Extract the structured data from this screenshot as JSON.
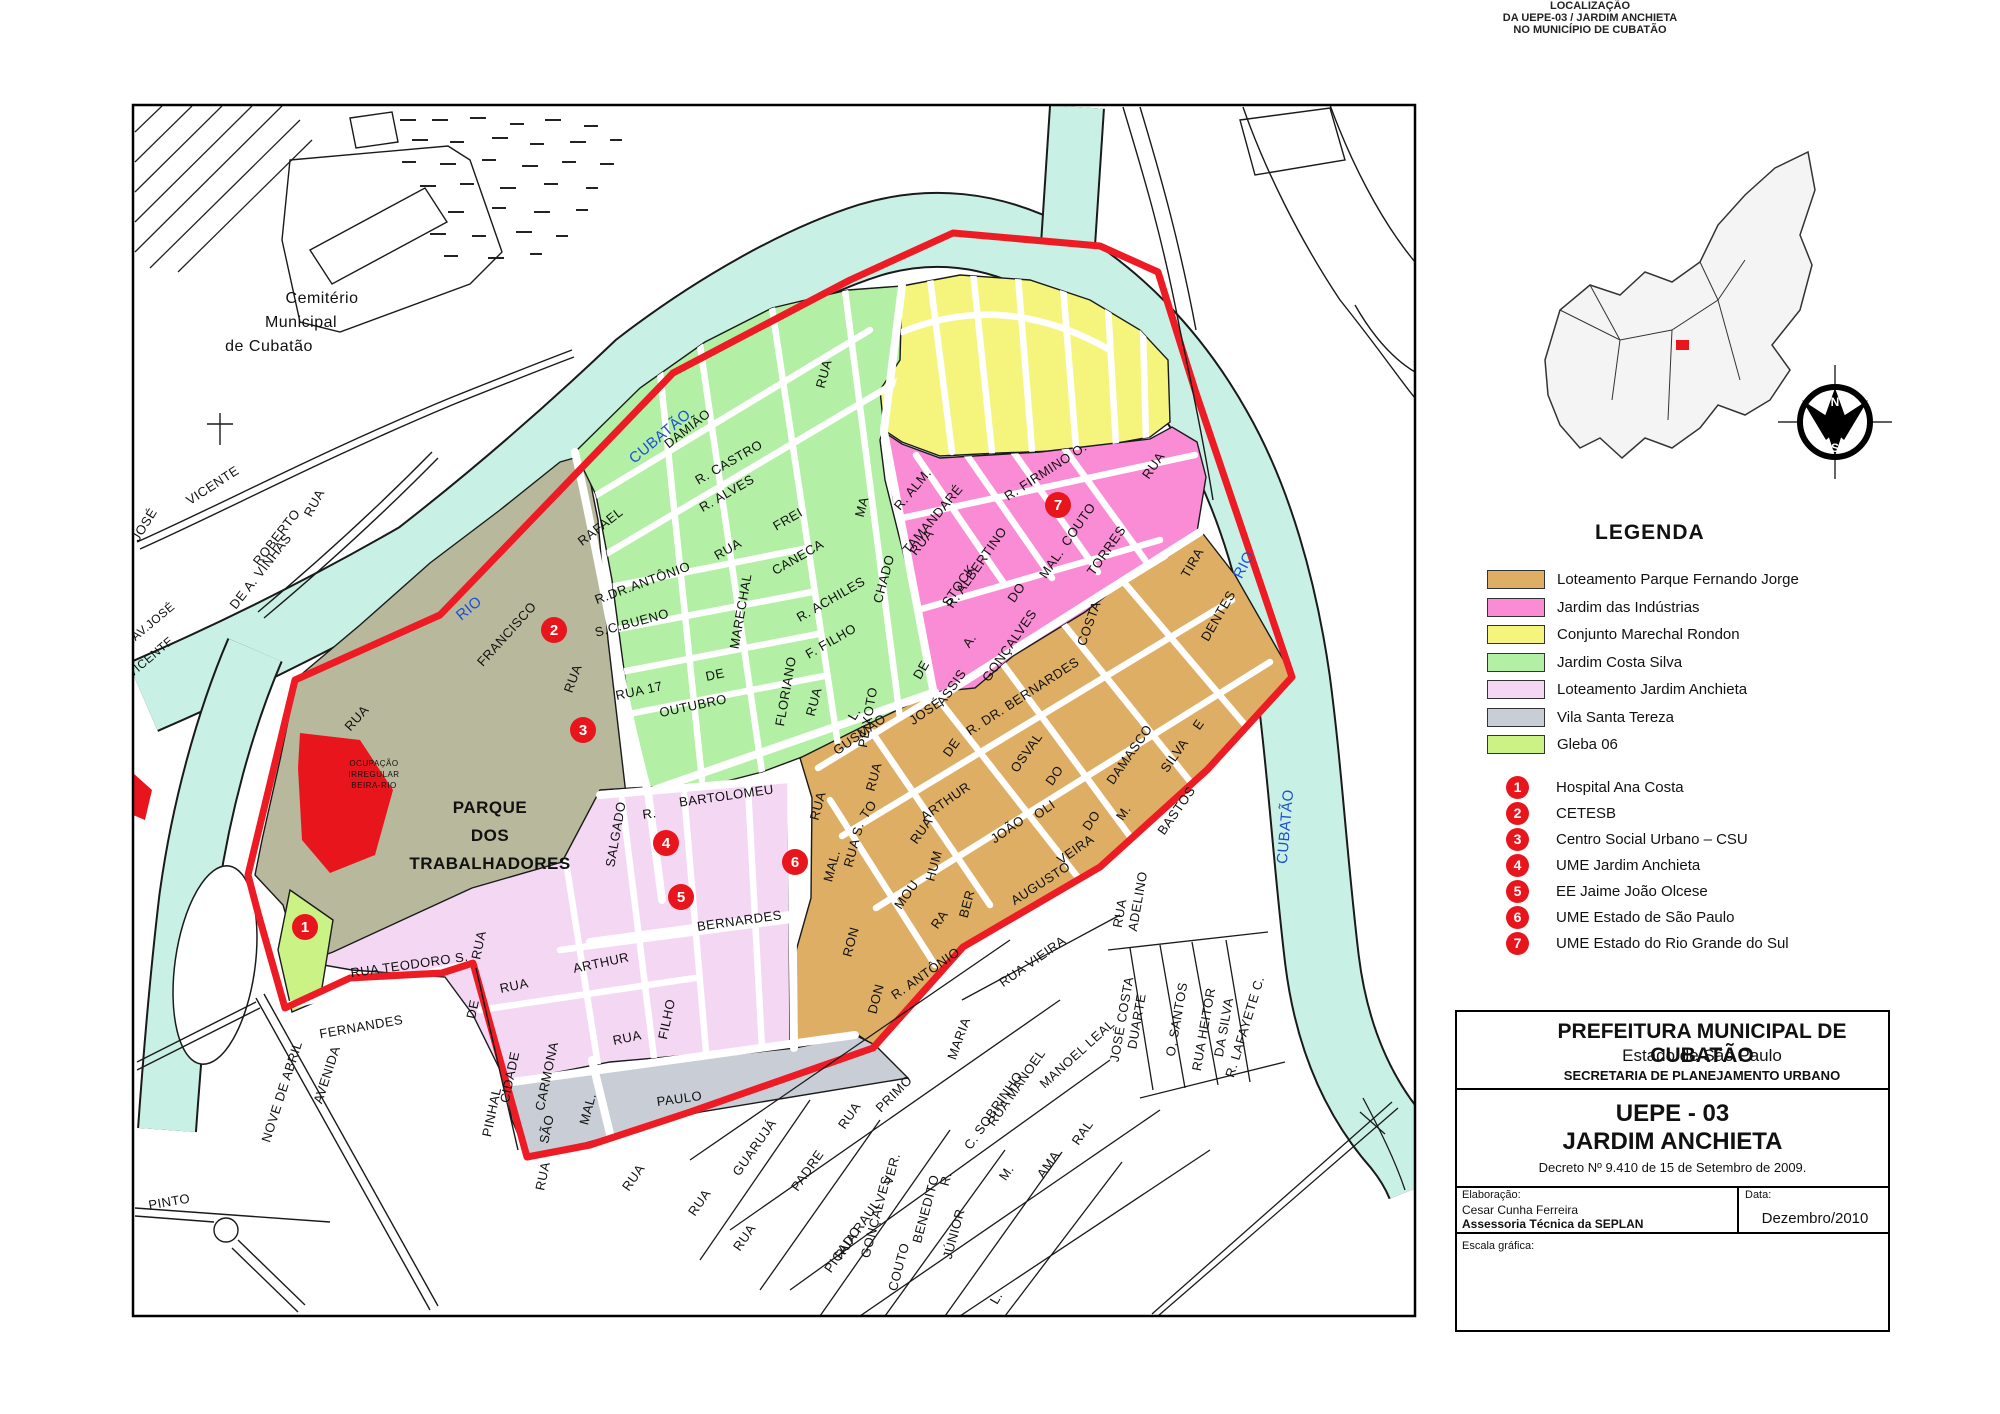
{
  "locator": {
    "title_lines": [
      "LOCALIZAÇÃO",
      "DA UEPE-03 / JARDIM ANCHIETA",
      "NO MUNICÍPIO DE CUBATÃO"
    ]
  },
  "compass": {
    "n": "N",
    "s": "S",
    "o": "O",
    "l": "L"
  },
  "legend": {
    "heading": "LEGENDA",
    "zones": [
      {
        "label": "Loteamento Parque Fernando Jorge",
        "color": "#ddae63"
      },
      {
        "label": "Jardim das Indústrias",
        "color": "#f98cd5"
      },
      {
        "label": "Conjunto Marechal Rondon",
        "color": "#f5f57e"
      },
      {
        "label": "Jardim Costa Silva",
        "color": "#b3efa5"
      },
      {
        "label": "Loteamento Jardim Anchieta",
        "color": "#f3d7f3"
      },
      {
        "label": "Vila Santa Tereza",
        "color": "#c9ced6"
      },
      {
        "label": "Gleba 06",
        "color": "#cbf284"
      }
    ],
    "pois": [
      {
        "num": "1",
        "label": "Hospital Ana Costa"
      },
      {
        "num": "2",
        "label": "CETESB"
      },
      {
        "num": "3",
        "label": "Centro Social Urbano – CSU"
      },
      {
        "num": "4",
        "label": "UME Jardim Anchieta"
      },
      {
        "num": "5",
        "label": "EE Jaime João Olcese"
      },
      {
        "num": "6",
        "label": "UME Estado de São Paulo"
      },
      {
        "num": "7",
        "label": "UME Estado do Rio Grande do Sul"
      }
    ]
  },
  "title_block": {
    "org": "PREFEITURA MUNICIPAL DE CUBATÃO",
    "state": "Estado de São Paulo",
    "dept": "SECRETARIA DE PLANEJAMENTO URBANO",
    "code": "UEPE - 03",
    "name": "JARDIM ANCHIETA",
    "decree": "Decreto Nº 9.410 de 15 de Setembro de 2009.",
    "elab_label": "Elaboração:",
    "author": "Cesar Cunha Ferreira",
    "team": "Assessoria Técnica da SEPLAN",
    "date_label": "Data:",
    "date_value": "Dezembro/2010",
    "scale_label": "Escala gráfica:",
    "crest_city": "CUBATÃO",
    "crest_years": [
      "1823",
      "1949"
    ]
  },
  "scalebar": {
    "ticks": [
      "0",
      "50",
      "100",
      "150",
      "200",
      "250"
    ],
    "unit": "metros"
  },
  "map": {
    "markers": [
      {
        "n": "1",
        "x": 305,
        "y": 927
      },
      {
        "n": "2",
        "x": 554,
        "y": 630
      },
      {
        "n": "3",
        "x": 583,
        "y": 730
      },
      {
        "n": "4",
        "x": 666,
        "y": 843
      },
      {
        "n": "5",
        "x": 681,
        "y": 897
      },
      {
        "n": "6",
        "x": 795,
        "y": 862
      },
      {
        "n": "7",
        "x": 1058,
        "y": 505
      }
    ],
    "labels": [
      {
        "t": "Cemitério",
        "x": 322,
        "y": 303,
        "r": 0,
        "s": 16
      },
      {
        "t": "Municipal",
        "x": 301,
        "y": 327,
        "r": 0,
        "s": 16
      },
      {
        "t": "de Cubatão",
        "x": 269,
        "y": 351,
        "r": 0,
        "s": 16
      },
      {
        "t": "JOSÉ",
        "x": 148,
        "y": 527,
        "r": -58
      },
      {
        "t": "VICENTE",
        "x": 215,
        "y": 489,
        "r": -33
      },
      {
        "t": "RUA",
        "x": 318,
        "y": 505,
        "r": -62
      },
      {
        "t": "ROBERTO",
        "x": 280,
        "y": 540,
        "r": -52
      },
      {
        "t": "DE A. VINHAS",
        "x": 264,
        "y": 574,
        "r": -52
      },
      {
        "t": "TRAV.JOSÉ",
        "x": 149,
        "y": 630,
        "r": -40,
        "s": 12
      },
      {
        "t": "VICENTE",
        "x": 153,
        "y": 660,
        "r": -40,
        "s": 12
      },
      {
        "t": "RUA",
        "x": 360,
        "y": 721,
        "r": -48
      },
      {
        "t": "RUA TEODORO S.",
        "x": 410,
        "y": 969,
        "r": -8
      },
      {
        "t": "FERNANDES",
        "x": 362,
        "y": 1031,
        "r": -10
      },
      {
        "t": "AVENIDA",
        "x": 331,
        "y": 1076,
        "r": -72
      },
      {
        "t": "NOVE DE ABRIL",
        "x": 286,
        "y": 1093,
        "r": -72
      },
      {
        "t": "PINTO",
        "x": 170,
        "y": 1206,
        "r": -10
      },
      {
        "t": "RUA",
        "x": 483,
        "y": 946,
        "r": -78
      },
      {
        "t": "DE",
        "x": 477,
        "y": 1010,
        "r": -78
      },
      {
        "t": "CIDADE",
        "x": 514,
        "y": 1078,
        "r": -78
      },
      {
        "t": "PINHAL",
        "x": 496,
        "y": 1113,
        "r": -78
      },
      {
        "t": "RUA",
        "x": 547,
        "y": 1177,
        "r": -78
      },
      {
        "t": "PARQUE",
        "x": 490,
        "y": 813,
        "r": 0,
        "s": 17,
        "w": "bold"
      },
      {
        "t": "DOS",
        "x": 490,
        "y": 841,
        "r": 0,
        "s": 17,
        "w": "bold"
      },
      {
        "t": "TRABALHADORES",
        "x": 490,
        "y": 869,
        "r": 0,
        "s": 17,
        "w": "bold"
      },
      {
        "t": "OCUPAÇÃO",
        "x": 374,
        "y": 766,
        "r": 0,
        "s": 8
      },
      {
        "t": "IRREGULAR",
        "x": 374,
        "y": 777,
        "r": 0,
        "s": 8
      },
      {
        "t": "BEIRA-RIO",
        "x": 374,
        "y": 788,
        "r": 0,
        "s": 8
      },
      {
        "t": "RIO",
        "x": 472,
        "y": 612,
        "r": -40,
        "s": 15,
        "c": "#1d4fd7"
      },
      {
        "t": "CUBATÃO",
        "x": 663,
        "y": 440,
        "r": -40,
        "s": 15,
        "c": "#1d4fd7"
      },
      {
        "t": "RIO",
        "x": 1248,
        "y": 567,
        "r": -63,
        "s": 15,
        "c": "#1d4fd7"
      },
      {
        "t": "CUBATÃO",
        "x": 1290,
        "y": 827,
        "r": -85,
        "s": 15,
        "c": "#1d4fd7"
      },
      {
        "t": "FRANCISCO",
        "x": 510,
        "y": 637,
        "r": -48
      },
      {
        "t": "RUA",
        "x": 577,
        "y": 680,
        "r": -70
      },
      {
        "t": "SALGADO",
        "x": 620,
        "y": 835,
        "r": -80
      },
      {
        "t": "RAFAEL",
        "x": 603,
        "y": 530,
        "r": -38
      },
      {
        "t": "DAMIÃO",
        "x": 690,
        "y": 432,
        "r": -38
      },
      {
        "t": "R. CASTRO",
        "x": 731,
        "y": 466,
        "r": -30
      },
      {
        "t": "R. ALVES",
        "x": 729,
        "y": 497,
        "r": -30
      },
      {
        "t": "RUA",
        "x": 730,
        "y": 553,
        "r": -30
      },
      {
        "t": "FREI",
        "x": 790,
        "y": 523,
        "r": -30
      },
      {
        "t": "CANECA",
        "x": 800,
        "y": 561,
        "r": -30
      },
      {
        "t": "RUA",
        "x": 828,
        "y": 375,
        "r": -75
      },
      {
        "t": "MA",
        "x": 866,
        "y": 508,
        "r": -75
      },
      {
        "t": "CHADO",
        "x": 888,
        "y": 580,
        "r": -75
      },
      {
        "t": "DE",
        "x": 925,
        "y": 672,
        "r": -60
      },
      {
        "t": "ASSIS",
        "x": 955,
        "y": 690,
        "r": -55
      },
      {
        "t": "MARECHAL",
        "x": 745,
        "y": 612,
        "r": -80
      },
      {
        "t": "FLORIANO",
        "x": 790,
        "y": 692,
        "r": -80
      },
      {
        "t": "PEIXOTO",
        "x": 872,
        "y": 718,
        "r": -80
      },
      {
        "t": "R.DR.ANTÔNIO",
        "x": 644,
        "y": 587,
        "r": -20
      },
      {
        "t": "S.C.BUENO",
        "x": 633,
        "y": 627,
        "r": -15
      },
      {
        "t": "RUA 17",
        "x": 640,
        "y": 695,
        "r": -12
      },
      {
        "t": "DE",
        "x": 716,
        "y": 679,
        "r": -12
      },
      {
        "t": "OUTUBRO",
        "x": 694,
        "y": 710,
        "r": -12
      },
      {
        "t": "R. ACHILES",
        "x": 833,
        "y": 603,
        "r": -30
      },
      {
        "t": "F. FILHO",
        "x": 833,
        "y": 645,
        "r": -30
      },
      {
        "t": "L.",
        "x": 858,
        "y": 716,
        "r": -60
      },
      {
        "t": "R. ALM.",
        "x": 916,
        "y": 492,
        "r": -50
      },
      {
        "t": "TAMANDARÉ",
        "x": 936,
        "y": 522,
        "r": -50
      },
      {
        "t": "RUA",
        "x": 925,
        "y": 545,
        "r": -50
      },
      {
        "t": "R. FIRMINO O.",
        "x": 1048,
        "y": 475,
        "r": -33
      },
      {
        "t": "COUTO",
        "x": 1082,
        "y": 527,
        "r": -55
      },
      {
        "t": "MAL.",
        "x": 1055,
        "y": 566,
        "r": -55
      },
      {
        "t": "TORRES",
        "x": 1110,
        "y": 553,
        "r": -55
      },
      {
        "t": "STOCK",
        "x": 962,
        "y": 588,
        "r": -55
      },
      {
        "t": "R. ALBERTINO",
        "x": 980,
        "y": 570,
        "r": -55
      },
      {
        "t": "A.",
        "x": 973,
        "y": 643,
        "r": -55
      },
      {
        "t": "DO",
        "x": 1020,
        "y": 595,
        "r": -55
      },
      {
        "t": "GONÇALVES",
        "x": 1013,
        "y": 648,
        "r": -55
      },
      {
        "t": "RUA",
        "x": 1157,
        "y": 468,
        "r": -55
      },
      {
        "t": "GUSMÃO",
        "x": 862,
        "y": 738,
        "r": -35
      },
      {
        "t": "JOSÉ",
        "x": 928,
        "y": 715,
        "r": -35
      },
      {
        "t": "RUA",
        "x": 818,
        "y": 703,
        "r": -75
      },
      {
        "t": "DE",
        "x": 955,
        "y": 750,
        "r": -55
      },
      {
        "t": "RUA",
        "x": 878,
        "y": 778,
        "r": -75
      },
      {
        "t": "TO",
        "x": 872,
        "y": 812,
        "r": -55
      },
      {
        "t": "RUA S.",
        "x": 858,
        "y": 846,
        "r": -75
      },
      {
        "t": "MOU",
        "x": 910,
        "y": 897,
        "r": -55
      },
      {
        "t": "RA",
        "x": 943,
        "y": 922,
        "r": -55
      },
      {
        "t": "ARTHUR",
        "x": 948,
        "y": 805,
        "r": -35
      },
      {
        "t": "RUA",
        "x": 925,
        "y": 833,
        "r": -55
      },
      {
        "t": "HUM",
        "x": 938,
        "y": 867,
        "r": -75
      },
      {
        "t": "BER",
        "x": 971,
        "y": 905,
        "r": -75
      },
      {
        "t": "JOÃO",
        "x": 1010,
        "y": 833,
        "r": -35
      },
      {
        "t": "OLI",
        "x": 1047,
        "y": 813,
        "r": -35
      },
      {
        "t": "VEIRA",
        "x": 1078,
        "y": 853,
        "r": -35
      },
      {
        "t": "R. DR. BERNARDES",
        "x": 1025,
        "y": 700,
        "r": -33
      },
      {
        "t": "OSVAL",
        "x": 1030,
        "y": 755,
        "r": -55
      },
      {
        "t": "DO",
        "x": 1058,
        "y": 778,
        "r": -55
      },
      {
        "t": "DAMASCO",
        "x": 1133,
        "y": 757,
        "r": -55
      },
      {
        "t": "AUGUSTO",
        "x": 1043,
        "y": 887,
        "r": -33
      },
      {
        "t": "DO",
        "x": 1095,
        "y": 823,
        "r": -55
      },
      {
        "t": "M.",
        "x": 1127,
        "y": 815,
        "r": -55
      },
      {
        "t": "BASTOS",
        "x": 1180,
        "y": 813,
        "r": -55
      },
      {
        "t": "COSTA",
        "x": 1093,
        "y": 625,
        "r": -70
      },
      {
        "t": "E",
        "x": 1202,
        "y": 727,
        "r": -55
      },
      {
        "t": "SILVA",
        "x": 1178,
        "y": 758,
        "r": -55
      },
      {
        "t": "TIRA",
        "x": 1196,
        "y": 565,
        "r": -60
      },
      {
        "t": "DENTES",
        "x": 1222,
        "y": 618,
        "r": -60
      },
      {
        "t": "RUA",
        "x": 822,
        "y": 807,
        "r": -75
      },
      {
        "t": "MAL.",
        "x": 836,
        "y": 867,
        "r": -75
      },
      {
        "t": "RON",
        "x": 855,
        "y": 943,
        "r": -75
      },
      {
        "t": "DON",
        "x": 880,
        "y": 1000,
        "r": -75
      },
      {
        "t": "R. ANTÔNIO",
        "x": 928,
        "y": 977,
        "r": -35
      },
      {
        "t": "R.",
        "x": 650,
        "y": 818,
        "r": -8
      },
      {
        "t": "BARTOLOMEU",
        "x": 727,
        "y": 800,
        "r": -8
      },
      {
        "t": "BERNARDES",
        "x": 740,
        "y": 925,
        "r": -8
      },
      {
        "t": "RUA",
        "x": 515,
        "y": 990,
        "r": -12
      },
      {
        "t": "ARTHUR",
        "x": 602,
        "y": 967,
        "r": -12
      },
      {
        "t": "FILHO",
        "x": 671,
        "y": 1020,
        "r": -78
      },
      {
        "t": "RUA",
        "x": 628,
        "y": 1042,
        "r": -12
      },
      {
        "t": "CARMONA",
        "x": 551,
        "y": 1077,
        "r": -78
      },
      {
        "t": "SÃO",
        "x": 551,
        "y": 1130,
        "r": -78
      },
      {
        "t": "MAL.",
        "x": 592,
        "y": 1110,
        "r": -75
      },
      {
        "t": "PAULO",
        "x": 680,
        "y": 1103,
        "r": -8
      },
      {
        "t": "RUA",
        "x": 637,
        "y": 1180,
        "r": -55
      },
      {
        "t": "RUA",
        "x": 703,
        "y": 1205,
        "r": -55
      },
      {
        "t": "GUARUJÁ",
        "x": 758,
        "y": 1150,
        "r": -55
      },
      {
        "t": "RUA",
        "x": 748,
        "y": 1240,
        "r": -55
      },
      {
        "t": "PADRE",
        "x": 811,
        "y": 1173,
        "r": -55
      },
      {
        "t": "RUA RAUL",
        "x": 861,
        "y": 1232,
        "r": -55
      },
      {
        "t": "PICADO",
        "x": 846,
        "y": 1252,
        "r": -55
      },
      {
        "t": "VER.",
        "x": 896,
        "y": 1170,
        "r": -75
      },
      {
        "t": "GONÇALVES",
        "x": 880,
        "y": 1218,
        "r": -75
      },
      {
        "t": "BENEDITO",
        "x": 930,
        "y": 1210,
        "r": -75
      },
      {
        "t": "COUTO",
        "x": 903,
        "y": 1268,
        "r": -75
      },
      {
        "t": "R.",
        "x": 950,
        "y": 1180,
        "r": -75
      },
      {
        "t": "JÚNIOR",
        "x": 958,
        "y": 1235,
        "r": -75
      },
      {
        "t": "L.",
        "x": 1000,
        "y": 1300,
        "r": -60
      },
      {
        "t": "MARIA",
        "x": 963,
        "y": 1040,
        "r": -70
      },
      {
        "t": "PRIMO",
        "x": 897,
        "y": 1097,
        "r": -45
      },
      {
        "t": "RUA",
        "x": 853,
        "y": 1118,
        "r": -55
      },
      {
        "t": "RUA MANOEL",
        "x": 1020,
        "y": 1090,
        "r": -55
      },
      {
        "t": "C. SOBRINHO",
        "x": 997,
        "y": 1113,
        "r": -55
      },
      {
        "t": "M.",
        "x": 1010,
        "y": 1175,
        "r": -55
      },
      {
        "t": "AMA",
        "x": 1052,
        "y": 1167,
        "r": -55
      },
      {
        "t": "RAL",
        "x": 1086,
        "y": 1135,
        "r": -55
      },
      {
        "t": "MANOEL LEAL",
        "x": 1080,
        "y": 1057,
        "r": -42
      },
      {
        "t": "RUA VIEIRA",
        "x": 1035,
        "y": 965,
        "r": -35
      },
      {
        "t": "DUARTE",
        "x": 1141,
        "y": 1022,
        "r": -80
      },
      {
        "t": "JOSÉ COSTA",
        "x": 1126,
        "y": 1020,
        "r": -80
      },
      {
        "t": "O. SANTOS",
        "x": 1181,
        "y": 1020,
        "r": -80
      },
      {
        "t": "RUA HEITOR",
        "x": 1208,
        "y": 1030,
        "r": -80
      },
      {
        "t": "DA SILVA",
        "x": 1228,
        "y": 1028,
        "r": -80
      },
      {
        "t": "R. LAFAYETE C.",
        "x": 1249,
        "y": 1028,
        "r": -73
      },
      {
        "t": "RUA",
        "x": 1124,
        "y": 914,
        "r": -80
      },
      {
        "t": "ADELINO",
        "x": 1142,
        "y": 902,
        "r": -80
      }
    ]
  }
}
